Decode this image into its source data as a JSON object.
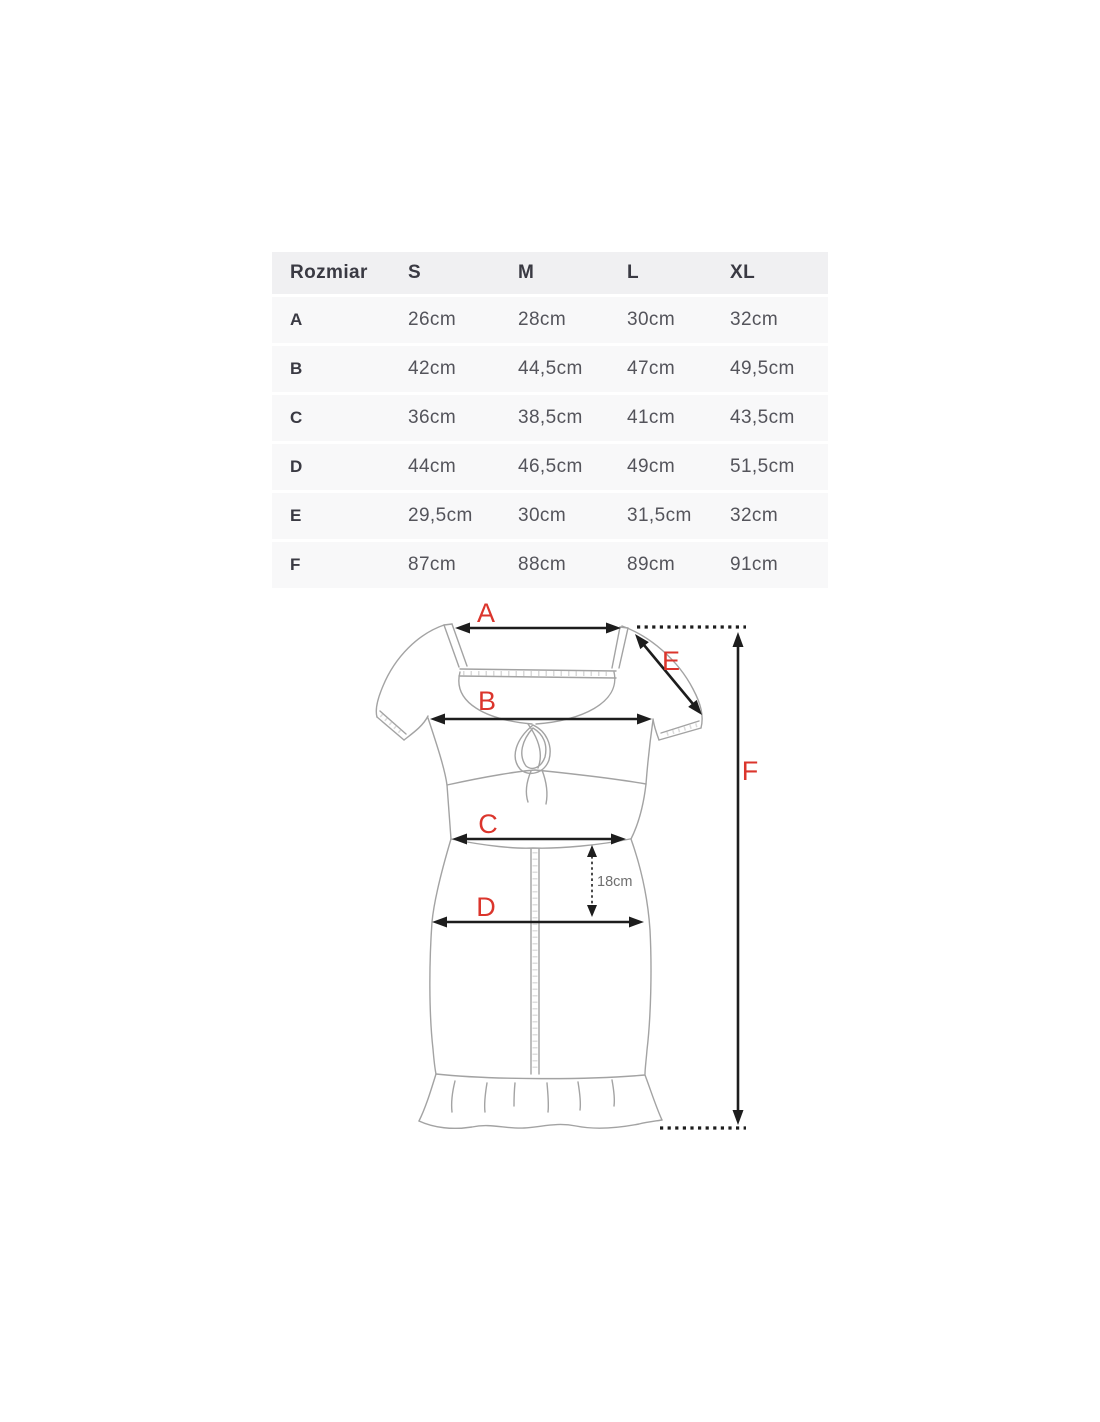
{
  "page": {
    "background": "#ffffff"
  },
  "size_table": {
    "header": {
      "label": "Rozmiar",
      "sizes": [
        "S",
        "M",
        "L",
        "XL"
      ]
    },
    "rows": [
      {
        "label": "A",
        "values": [
          "26cm",
          "28cm",
          "30cm",
          "32cm"
        ]
      },
      {
        "label": "B",
        "values": [
          "42cm",
          "44,5cm",
          "47cm",
          "49,5cm"
        ]
      },
      {
        "label": "C",
        "values": [
          "36cm",
          "38,5cm",
          "41cm",
          "43,5cm"
        ]
      },
      {
        "label": "D",
        "values": [
          "44cm",
          "46,5cm",
          "49cm",
          "51,5cm"
        ]
      },
      {
        "label": "E",
        "values": [
          "29,5cm",
          "30cm",
          "31,5cm",
          "32cm"
        ]
      },
      {
        "label": "F",
        "values": [
          "87cm",
          "88cm",
          "89cm",
          "91cm"
        ]
      }
    ]
  },
  "diagram": {
    "measurement_labels": {
      "a": "A",
      "b": "B",
      "c": "C",
      "d": "D",
      "e": "E",
      "f": "F"
    },
    "inner_measurement": "18cm",
    "colors": {
      "label_red": "#db352c",
      "arrow_black": "#1d1d1d",
      "outline_grey": "#a3a3a3",
      "inner_text_grey": "#6f6f6f"
    }
  }
}
